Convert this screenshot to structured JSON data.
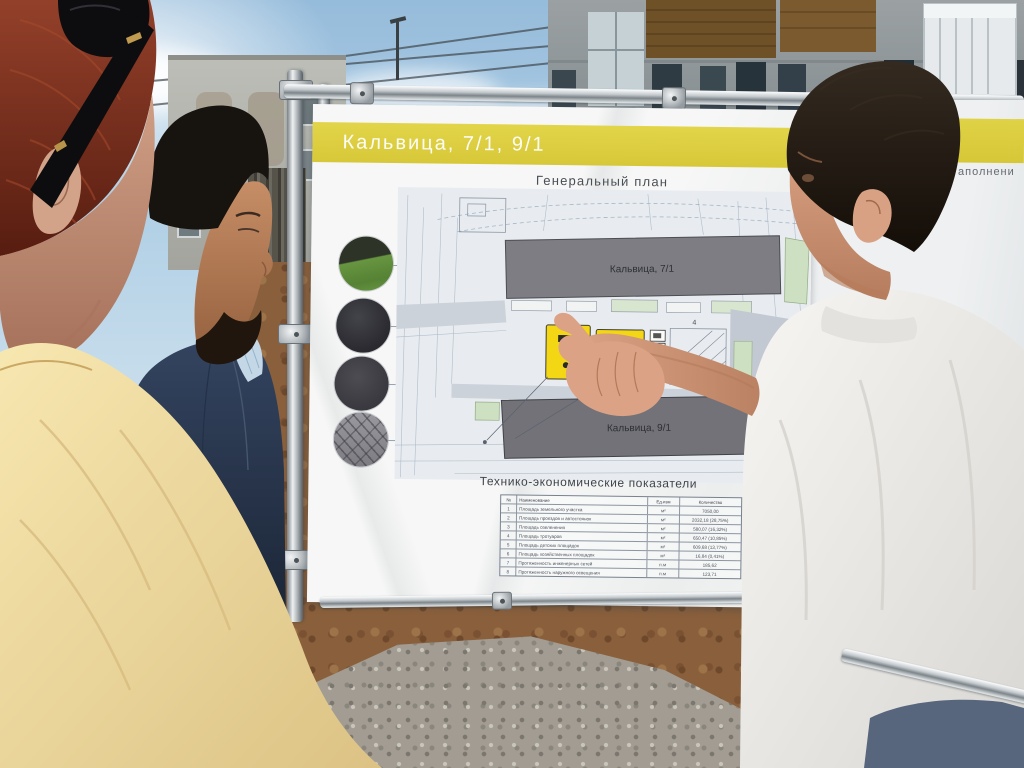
{
  "colors": {
    "accent_yellow": "#ddce41",
    "playground_yellow": "#f3d714",
    "plan_building_gray": "#7d7d83",
    "plan_greenery": "#cde0c2"
  },
  "board_main": {
    "header": "Кальвица, 7/1, 9/1",
    "plan_title": "Генеральный план",
    "buildings": {
      "top_label": "Кальвица, 7/1",
      "bottom_label": "Кальвица, 9/1"
    },
    "plot_numbers": [
      "4",
      "5",
      "7"
    ],
    "legend_swatches": [
      {
        "name": "lawn-grass"
      },
      {
        "name": "asphalt"
      },
      {
        "name": "rubber-coating"
      },
      {
        "name": "paving-tiles"
      }
    ],
    "side_note": "Приложение. Топосъемка",
    "table": {
      "title": "Технико-экономические показатели",
      "columns": [
        "№",
        "Наименование",
        "Ед.изм",
        "Количество"
      ],
      "rows": [
        [
          "1",
          "Площадь земельного участка",
          "м²",
          "7050,00"
        ],
        [
          "2",
          "Площадь проездов и автостоянок",
          "м²",
          "2032,18 (28,75%)"
        ],
        [
          "3",
          "Площадь озеленения",
          "м²",
          "580,07 (16,32%)"
        ],
        [
          "4",
          "Площадь тротуаров",
          "м²",
          "650,47 (10,85%)"
        ],
        [
          "5",
          "Площадь детских площадок",
          "м²",
          "609,68 (13,77%)"
        ],
        [
          "6",
          "Площадь хозяйственных площадок",
          "м²",
          "16,84 (0,41%)"
        ],
        [
          "7",
          "Протяженность инженерных сетей",
          "п.м",
          "185,62"
        ],
        [
          "8",
          "Протяженность наружного освещения",
          "п.м",
          "123,71"
        ]
      ]
    }
  },
  "board_secondary": {
    "header_fragment": "аполнени"
  }
}
